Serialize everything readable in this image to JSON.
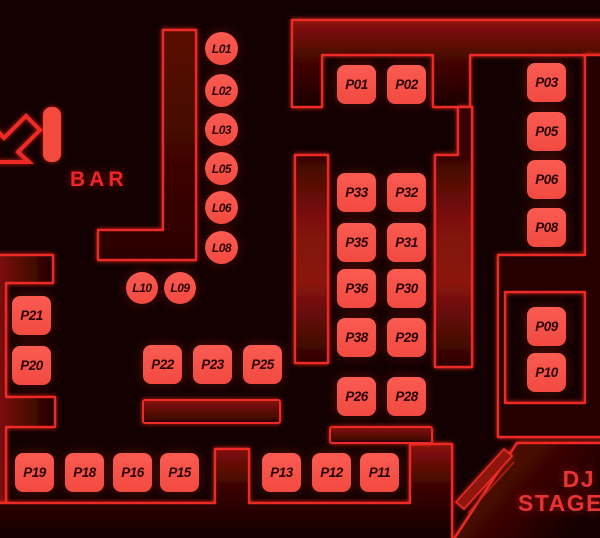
{
  "scene": {
    "type": "nightclub-floor-plan-seat-map"
  },
  "labels": {
    "bar": "BAR",
    "dj_line1": "DJ",
    "dj_line2": "STAGE"
  },
  "icons": {
    "entrance": "arrow-down-left-icon",
    "stage_stripe": "stage-chevron-stripe"
  },
  "colors": {
    "background": "#130102",
    "wall_line": "#ee2b26",
    "seat_fill": "#f8544a",
    "seat_text": "#2a0406",
    "glow": "#ff3b2e"
  },
  "seats": {
    "L01": "L01",
    "L02": "L02",
    "L03": "L03",
    "L05": "L05",
    "L06": "L06",
    "L08": "L08",
    "L10": "L10",
    "L09": "L09",
    "P01": "P01",
    "P02": "P02",
    "P03": "P03",
    "P05": "P05",
    "P06": "P06",
    "P08": "P08",
    "P09": "P09",
    "P10": "P10",
    "P11": "P11",
    "P12": "P12",
    "P13": "P13",
    "P15": "P15",
    "P16": "P16",
    "P18": "P18",
    "P19": "P19",
    "P20": "P20",
    "P21": "P21",
    "P22": "P22",
    "P23": "P23",
    "P25": "P25",
    "P26": "P26",
    "P28": "P28",
    "P29": "P29",
    "P30": "P30",
    "P31": "P31",
    "P32": "P32",
    "P33": "P33",
    "P35": "P35",
    "P36": "P36",
    "P38": "P38"
  }
}
